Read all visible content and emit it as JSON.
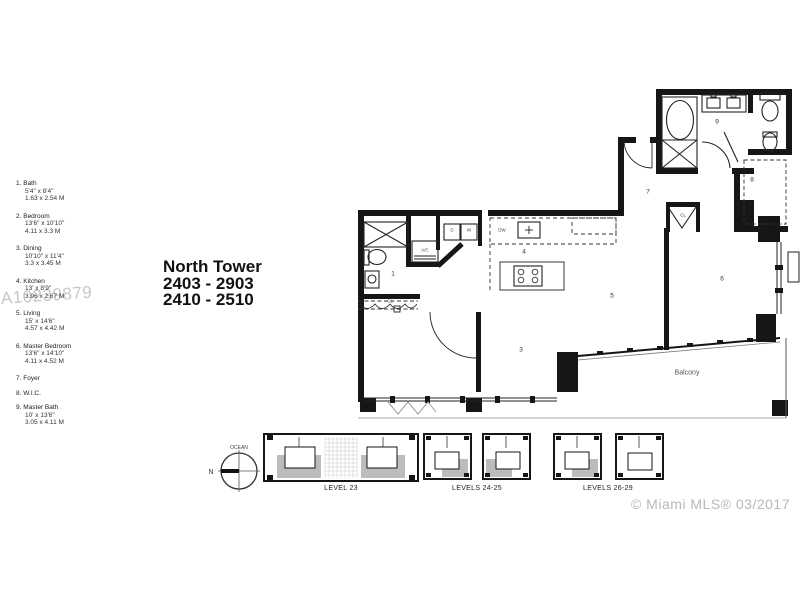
{
  "watermark": "A10239879",
  "copyright": "© Miami MLS® 03/2017",
  "title": {
    "line1": "North Tower",
    "line2": "2403 - 2903",
    "line3": "2410 - 2510"
  },
  "legend": {
    "items": [
      {
        "num": "1.",
        "name": "Bath",
        "imperial": "5'4\" x 8'4\"",
        "metric": "1.63 x 2.54 M"
      },
      {
        "num": "2.",
        "name": "Bedroom",
        "imperial": "13'6\" x 10'10\"",
        "metric": "4.11 x 3.3 M"
      },
      {
        "num": "3.",
        "name": "Dining",
        "imperial": "10'10\" x 11'4\"",
        "metric": "3.3 x 3.45 M"
      },
      {
        "num": "4.",
        "name": "Kitchen",
        "imperial": "13' x 8'9\"",
        "metric": "3.96 x 2.67 M"
      },
      {
        "num": "5.",
        "name": "Living",
        "imperial": "15' x 14'6\"",
        "metric": "4.57 x 4.42 M"
      },
      {
        "num": "6.",
        "name": "Master Bedroom",
        "imperial": "13'6\" x 14'10\"",
        "metric": "4.11 x 4.52 M"
      },
      {
        "num": "7.",
        "name": "Foyer"
      },
      {
        "num": "8.",
        "name": "W.I.C."
      },
      {
        "num": "9.",
        "name": "Master Bath",
        "imperial": "10' x 13'6\"",
        "metric": "3.05 x 4.11 M"
      }
    ]
  },
  "plan": {
    "labels": {
      "bath": "1",
      "dining": "3",
      "kitchen": "4",
      "living": "5",
      "master_bedroom": "6",
      "foyer": "7",
      "wic": "8",
      "master_bath": "9",
      "ac": "A/C",
      "dryer": "D",
      "washer": "W",
      "dishwasher": "DW",
      "closet_bedroom": "CL",
      "closet_master": "CL",
      "balcony": "Balcony"
    }
  },
  "key_plans": {
    "compass": {
      "north": "N",
      "ocean": "OCEAN"
    },
    "levels": [
      {
        "label": "LEVEL 23"
      },
      {
        "label": "LEVELS 24-25"
      },
      {
        "label": "LEVELS 26-29"
      }
    ]
  },
  "colors": {
    "wall": "#161616",
    "gray_shade": "#bcbcbc",
    "watermark": "#c6c6c6",
    "copyright": "#b8b8b8"
  }
}
